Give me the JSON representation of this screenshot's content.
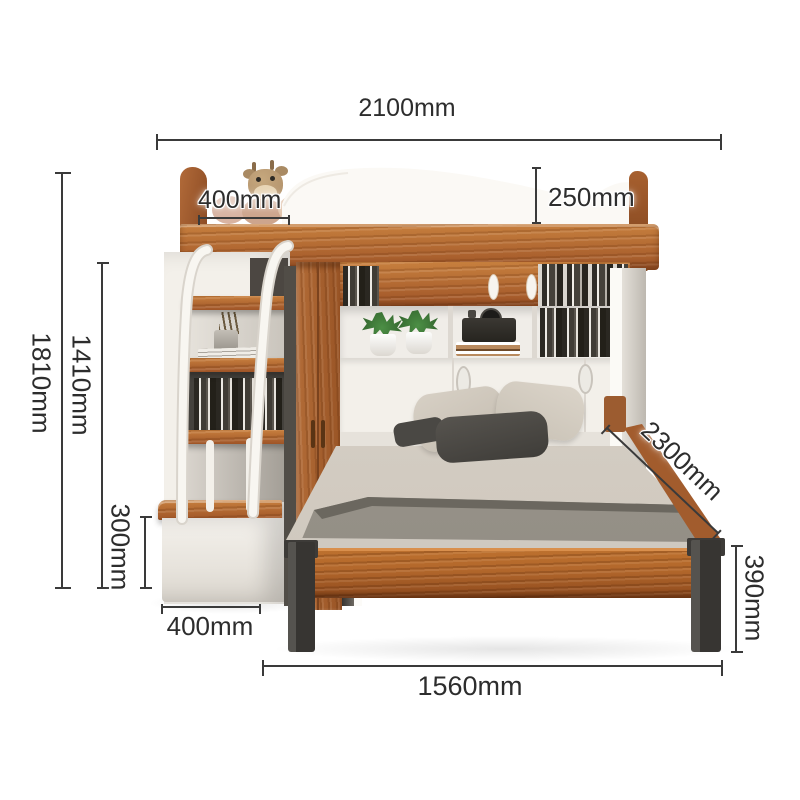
{
  "scene": {
    "description": "Loft bunk bed with storage staircase, sliding-door wardrobe, bookshelf headboard and lower double bed, annotated with product dimensions"
  },
  "dimensions": {
    "total_width": "2100mm",
    "upper_bunk_depth": "400mm",
    "guardrail_height": "250mm",
    "total_height": "1810mm",
    "staircase_height": "1410mm",
    "bottom_step_height": "300mm",
    "staircase_depth": "400mm",
    "lower_bed_length": "1560mm",
    "lower_bed_depth": "2300mm",
    "leg_height": "390mm"
  },
  "colors": {
    "wood": "#b46d38",
    "wood_dark": "#8e4a1d",
    "white_panel": "#f4f1ec",
    "metal_leg": "#373532",
    "mattress": "#d3ccc2",
    "blanket": "#8d887f",
    "dimension_line": "#3a3a3a",
    "dimension_text": "#2d2d2d",
    "plant_green": "#3e7c37"
  }
}
